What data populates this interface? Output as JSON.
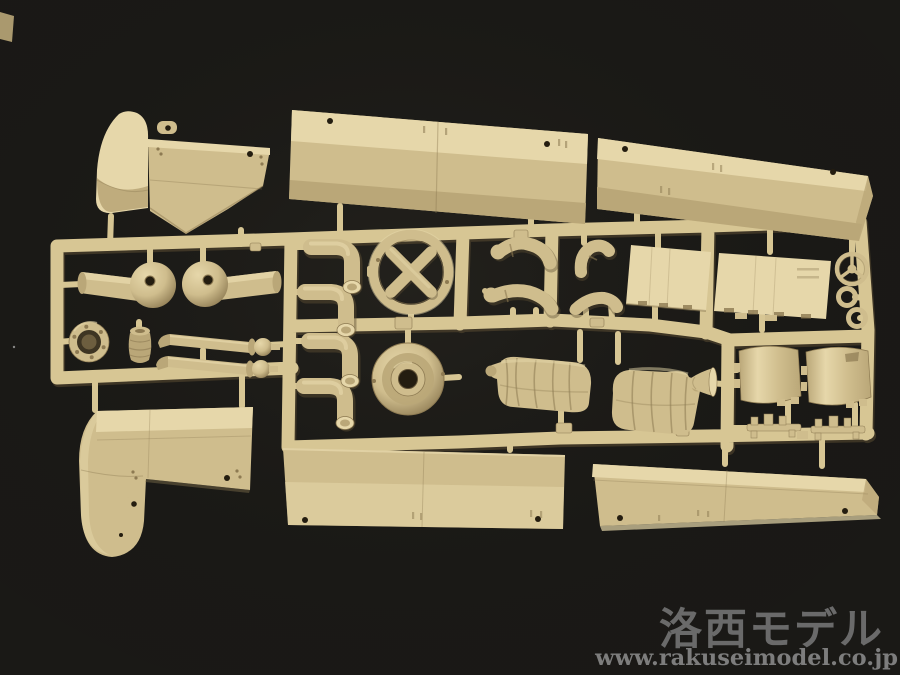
{
  "watermark": {
    "brand": "洛西モデル",
    "url": "www.rakuseimodel.co.jp"
  },
  "colors": {
    "background": "#1a1916",
    "plastic_light": "#e6d7aa",
    "plastic_base": "#cfbd8d",
    "plastic_mid": "#baa778",
    "plastic_shadow": "#8d7a52",
    "plastic_deep": "#5f5034",
    "runner": "#d7c694",
    "hole_dark": "#241d10",
    "watermark_text": "#7f7f7f",
    "watermark_url": "#8f8f8f",
    "speck": "#cfcfcf"
  },
  "sprue": {
    "description": "tan plastic model-kit sprue photographed on black background",
    "parts": [
      "front-fender-upper",
      "front-fender-lower",
      "side-panel-top-middle",
      "side-panel-top-right",
      "side-panel-bottom-middle",
      "side-panel-bottom-right",
      "axle-ball-housing-left",
      "axle-ball-housing-right",
      "flanged-ring",
      "ribbed-cap",
      "exhaust-pipe-1",
      "exhaust-pipe-2",
      "elbow-pipe-1",
      "elbow-pipe-2",
      "elbow-pipe-3",
      "elbow-pipe-4",
      "x-brace-ring",
      "wheel-hub-dish",
      "figure-arm-1",
      "figure-arm-2",
      "figure-arm-3",
      "figure-arm-4",
      "figure-torso-1",
      "figure-torso-2",
      "door-panel-1",
      "door-panel-2",
      "funnel-part",
      "steering-wheel",
      "small-ring-1",
      "small-ring-2",
      "seat-1",
      "seat-2",
      "rail-1",
      "rail-2"
    ]
  }
}
